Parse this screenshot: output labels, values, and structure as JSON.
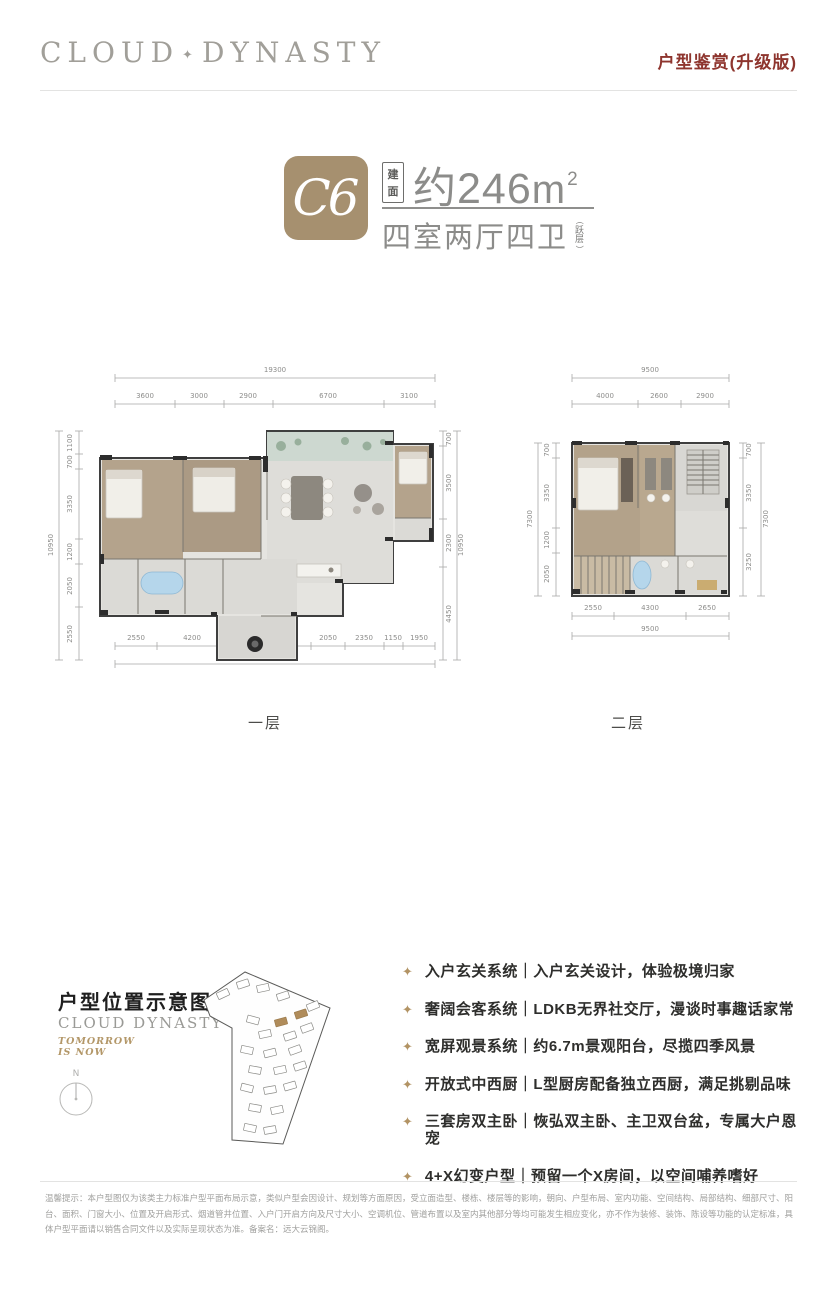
{
  "header": {
    "logo_left": "CLOUD",
    "logo_sep": "✦",
    "logo_right": "DYNASTY",
    "tagline": "户型鉴赏(升级版)",
    "tagline_color": "#8e352e"
  },
  "badge": {
    "unit": "C6",
    "tile_color": "#a6906f",
    "area_label": "建面",
    "area_value": "约246",
    "area_unit": "m",
    "area_sup": "2",
    "rooms": "四室两厅四卫",
    "paren_open": "(",
    "jump": "跃层",
    "paren_close": ")"
  },
  "plans": {
    "plan1": {
      "label": "一层",
      "top": {
        "total": "19300",
        "segs": [
          "3600",
          "3000",
          "2900",
          "6700",
          "3100"
        ]
      },
      "left": {
        "total": "10950",
        "segs": [
          "1100",
          "700",
          "3350",
          "1200",
          "2050",
          "2550"
        ]
      },
      "right": {
        "total": "10950",
        "segs": [
          "700",
          "3500",
          "2300",
          "4450"
        ]
      },
      "bottom": {
        "total": "19300",
        "segs": [
          "2550",
          "4200",
          "2350",
          "2700",
          "2050",
          "2350",
          "1150",
          "1950"
        ]
      }
    },
    "plan2": {
      "label": "二层",
      "top": {
        "total": "9500",
        "segs": [
          "4000",
          "2600",
          "2900"
        ]
      },
      "left": {
        "total": "7300",
        "segs": [
          "700",
          "3350",
          "1200",
          "2050"
        ]
      },
      "right": {
        "total": "7300",
        "segs": [
          "700",
          "3350",
          "3250"
        ]
      },
      "bottom": {
        "total": "9500",
        "segs": [
          "2550",
          "4300",
          "2650"
        ]
      }
    }
  },
  "location": {
    "title": "户型位置示意图",
    "brand": "CLOUD DYNASTY",
    "slogan_line1": "TOMORROW",
    "slogan_line2": "IS NOW",
    "compass_n": "N",
    "accent_color": "#b08d5f"
  },
  "features": {
    "star_icon": "✦",
    "items": [
      "入户玄关系统｜入户玄关设计，体验极境归家",
      "奢阔会客系统｜LDKB无界社交厅，漫谈时事趣话家常",
      "宽屏观景系统｜约6.7m景观阳台，尽揽四季风景",
      "开放式中西厨｜L型厨房配备独立西厨，满足挑剔品味",
      "三套房双主卧｜恢弘双主卧、主卫双台盆，专属大户恩宠",
      "4+X幻变户型｜预留一个X房间，以空间哺养嗜好"
    ]
  },
  "disclaimer": "温馨提示：本户型图仅为该类主力标准户型平面布局示意，类似户型会因设计、规划等方面原因，受立面造型、楼栋、楼层等的影响，朝向、户型布局、室内功能、空间结构、局部结构、细部尺寸、阳台、面积、门窗大小、位置及开启形式、烟道管井位置、入户门开启方向及尺寸大小、空调机位、管道布置以及室内其他部分等均可能发生相应变化，亦不作为装修、装饰、陈设等功能的认定标准，具体户型平面请以销售合同文件以及实际呈现状态为准。备案名：远大云锦阁。"
}
